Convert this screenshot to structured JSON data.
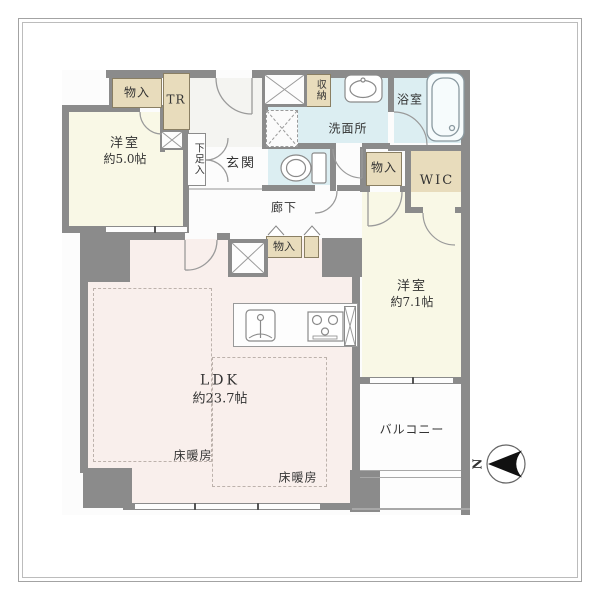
{
  "floorplan": {
    "rooms": {
      "yoshitsu5": {
        "name": "洋室",
        "size": "約5.0帖"
      },
      "yoshitsu7": {
        "name": "洋室",
        "size": "約7.1帖"
      },
      "ldk": {
        "name": "LDK",
        "size": "約23.7帖"
      },
      "genkan": "玄関",
      "rouka": "廊下",
      "senmenjo": "洗面所",
      "yokushitsu": "浴室",
      "wic": "WIC",
      "balcony": "バルコニー",
      "gesokuire": "下足入",
      "shunou": "収納",
      "trunk_room": "TR",
      "monoire": "物入",
      "yukadanbou": "床暖房"
    },
    "compass": {
      "north_label": "N"
    },
    "colors": {
      "wall": "#8b8b8b",
      "closet_beige": "#e8dcbc",
      "wet_area_blue": "#dceef2",
      "ldk_pink": "#f9efec",
      "bedroom_cream": "#f9f8e6"
    }
  }
}
